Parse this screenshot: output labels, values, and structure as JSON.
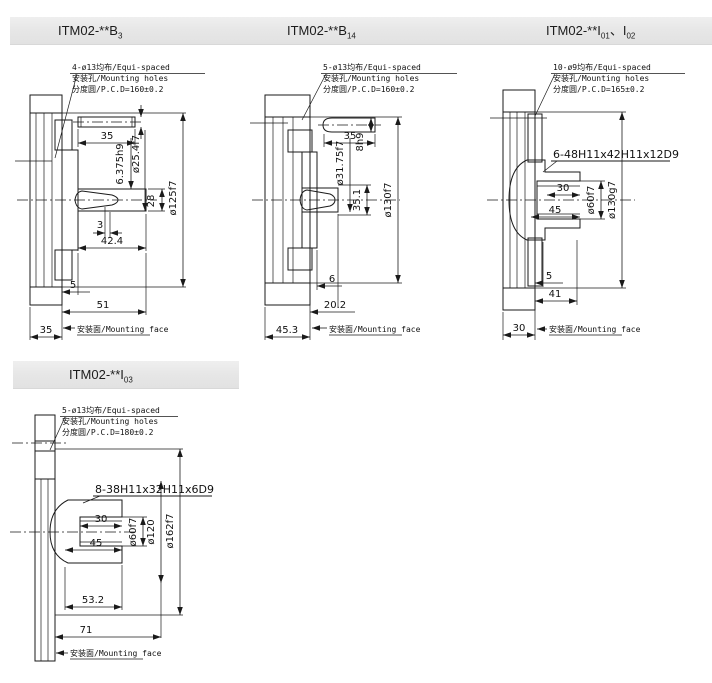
{
  "colors": {
    "background": "#ffffff",
    "panel_bar": "#e8e8e8",
    "line": "#1a1a1a"
  },
  "panels": [
    {
      "title": {
        "p1": "ITM02-**B",
        "s1": "3",
        "p2": "",
        "s2": ""
      },
      "note": {
        "line1": "4-ø13均布/Equi-spaced",
        "line2": "安装孔/Mounting holes",
        "line3": "分度圆/P.C.D=160±0.2"
      },
      "dims": {
        "key_length": "35",
        "key_height": "6.375h9",
        "shaft_dia": "ø25.4f7",
        "shaft_end_dia": "28",
        "pilot_dia": "ø125f7",
        "gap": "3",
        "shaft_length": "42.4",
        "step": "5",
        "hub_length": "51",
        "flange_thickness": "35"
      },
      "mounting_face": "安装面/Mounting face"
    },
    {
      "title": {
        "p1": "ITM02-**B",
        "s1": "14",
        "p2": "",
        "s2": ""
      },
      "note": {
        "line1": "5-ø13均布/Equi-spaced",
        "line2": "安装孔/Mounting holes",
        "line3": "分度圆/P.C.D=160±0.2"
      },
      "dims": {
        "key_length": "35",
        "key_width": "8h9",
        "shaft_dia": "ø31.75f7",
        "bore_dia": "35.1",
        "pilot_dia": "ø130f7",
        "step": "6",
        "shaft_length": "20.2",
        "flange_thickness": "45.3"
      },
      "mounting_face": "安装面/Mounting face"
    },
    {
      "title": {
        "p1": "ITM02-**I",
        "s1": "01",
        "p2": "、I",
        "s2": "02"
      },
      "note": {
        "line1": "10-ø9均布/Equi-spaced",
        "line2": "安装孔/Mounting holes",
        "line3": "分度圆/P.C.D=165±0.2"
      },
      "spline": "6-48H11x42H11x12D9",
      "dims": {
        "spline_depth": "30",
        "bore_depth": "45",
        "bore_dia": "ø60f7",
        "pilot_dia": "ø130g7",
        "step": "5",
        "hub_length": "41",
        "flange_thickness": "30"
      },
      "mounting_face": "安装面/Mounting face"
    },
    {
      "title": {
        "p1": "ITM02-**I",
        "s1": "03",
        "p2": "",
        "s2": ""
      },
      "note": {
        "line1": "5-ø13均布/Equi-spaced",
        "line2": "安装孔/Mounting holes",
        "line3": "分度圆/P.C.D=180±0.2"
      },
      "spline": "8-38H11x32H11x6D9",
      "dims": {
        "spline_depth": "30",
        "bore_depth": "45",
        "bore_dia": "ø60f7",
        "hub_dia": "ø120",
        "pilot_dia": "ø162f7",
        "hub_length": "53.2",
        "total_length": "71"
      },
      "mounting_face": "安装面/Mounting face"
    }
  ]
}
